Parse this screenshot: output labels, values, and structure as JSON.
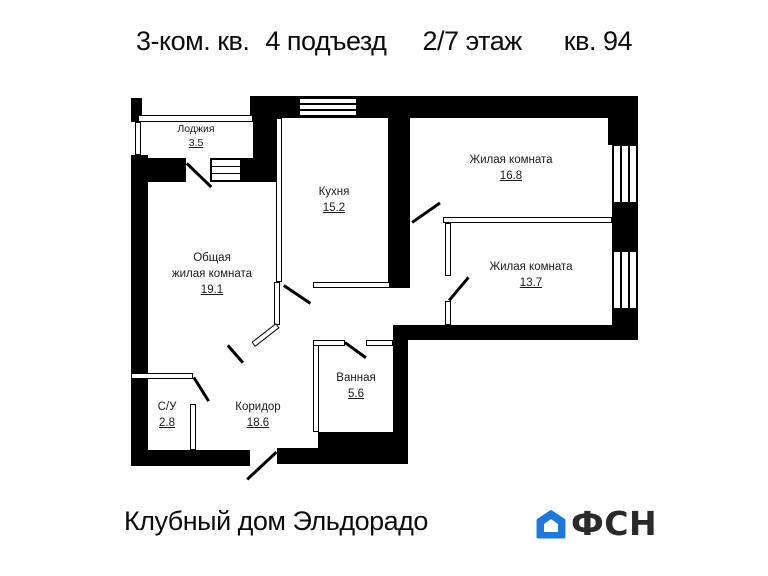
{
  "title": {
    "apartment": "3-ком. кв.",
    "entrance": "4 подъезд",
    "floor": "2/7 этаж",
    "number": "кв. 94"
  },
  "rooms": {
    "loggia": {
      "name": "Лоджия",
      "area": "3.5"
    },
    "kitchen": {
      "name": "Кухня",
      "area": "15.2"
    },
    "living1": {
      "name": "Жилая комната",
      "area": "16.8"
    },
    "living2": {
      "name": "Жилая комната",
      "area": "13.7"
    },
    "common": {
      "name_line1": "Общая",
      "name_line2": "жилая комната",
      "area": "19.1"
    },
    "bathroom": {
      "name": "Ванная",
      "area": "5.6"
    },
    "wc": {
      "name": "С/У",
      "area": "2.8"
    },
    "corridor": {
      "name": "Коридор",
      "area": "18.6"
    }
  },
  "footer": {
    "building": "Клубный дом Эльдорадо",
    "logo": "ФСН"
  },
  "colors": {
    "wall": "#000000",
    "logo_blue": "#1c78dc",
    "logo_dark": "#2b2a29"
  }
}
